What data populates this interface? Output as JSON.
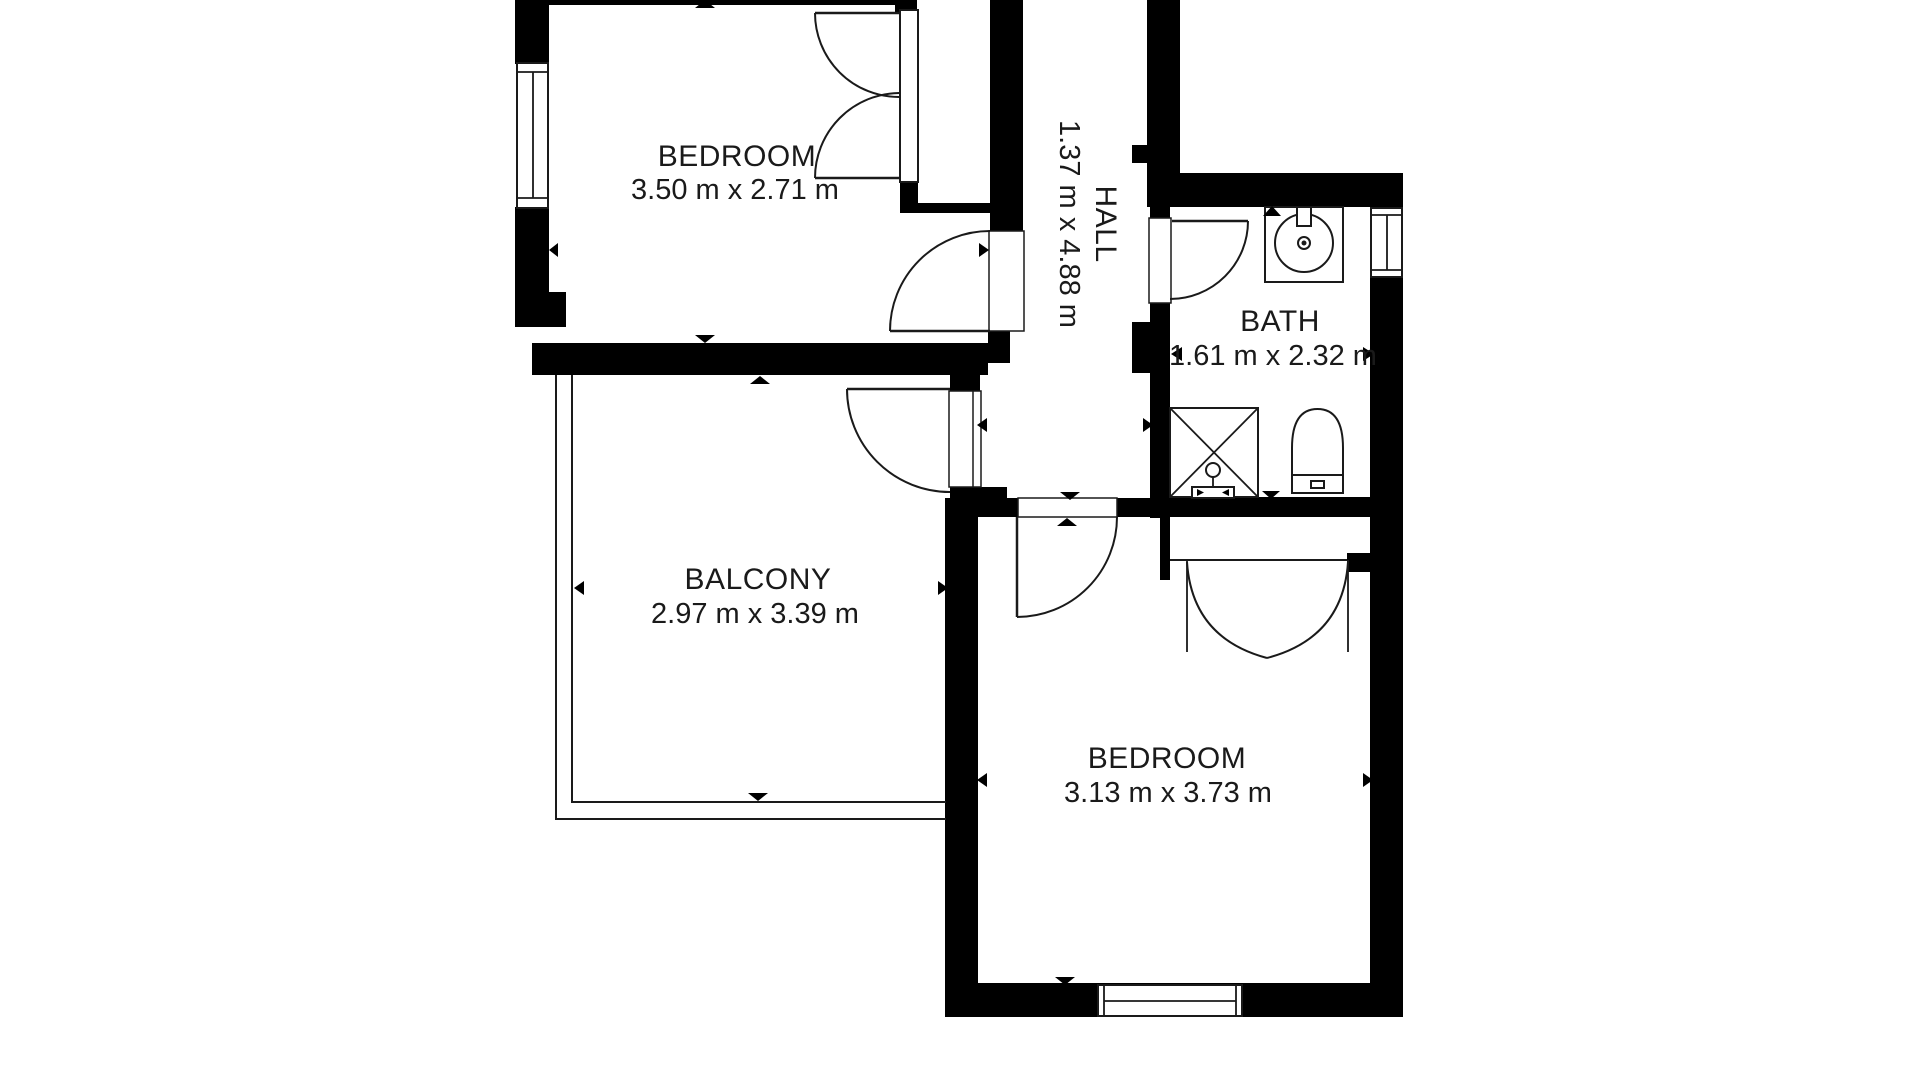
{
  "colors": {
    "background": "#ffffff",
    "walls": "#000000",
    "text": "#1a1a1a"
  },
  "rooms": [
    {
      "id": "bedroom-top",
      "name": "BEDROOM",
      "dims": "3.50 m x 2.71 m"
    },
    {
      "id": "hall",
      "name": "HALL",
      "dims": "1.37 m x 4.88 m"
    },
    {
      "id": "bath",
      "name": "BATH",
      "dims": "1.61 m x 2.32 m"
    },
    {
      "id": "balcony",
      "name": "BALCONY",
      "dims": "2.97 m x 3.39 m"
    },
    {
      "id": "bedroom-bottom",
      "name": "BEDROOM",
      "dims": "3.13 m x 3.73 m"
    }
  ],
  "fixtures": [
    {
      "id": "sink"
    },
    {
      "id": "shower"
    },
    {
      "id": "toilet"
    }
  ]
}
